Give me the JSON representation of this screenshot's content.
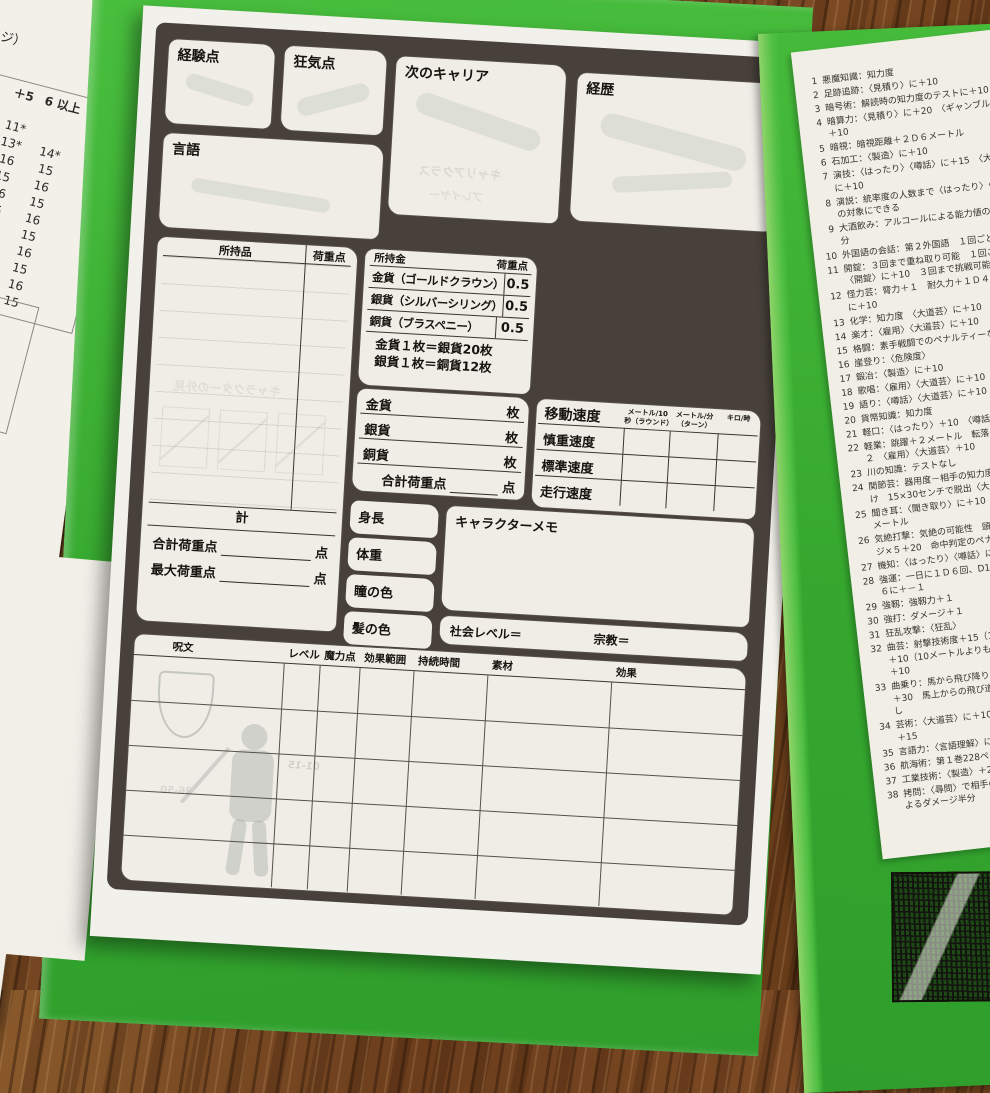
{
  "left_sheets": {
    "sheet1": {
      "top_fragment": "ページ）",
      "corner_label": "値",
      "columns": [
        "＋4",
        "＋5",
        "6 以上"
      ],
      "rows": [
        [
          "7",
          "",
          ""
        ],
        [
          "9*",
          "11*",
          ""
        ],
        [
          "4*",
          "13*",
          "14*"
        ],
        [
          "",
          "16",
          "15"
        ],
        [
          "",
          "15",
          "16"
        ],
        [
          "",
          "16",
          "15"
        ],
        [
          "",
          "15",
          "16"
        ],
        [
          "",
          "16",
          "15"
        ],
        [
          "",
          "15",
          "16"
        ],
        [
          "",
          "16",
          "15"
        ],
        [
          "",
          "15",
          "16"
        ],
        [
          "",
          "",
          "15"
        ]
      ],
      "footer": "せん──戦闘からの"
    },
    "sheet2": {
      "columns": [
        "＋5",
        "＋6"
      ],
      "rows": [
        [
          "し",
          "即死"
        ],
        [
          "死",
          "即死"
        ],
        [
          "死",
          "即死"
        ],
        [
          "死",
          "即死"
        ],
        [
          "死",
          "即死"
        ],
        [
          "死",
          "即死"
        ]
      ]
    }
  },
  "sheet": {
    "boxes": {
      "experience": "経験点",
      "insanity": "狂気点",
      "next_career": "次のキャリア",
      "history": "経歴",
      "language": "言語"
    },
    "possessions": {
      "title": "所持品",
      "weight_col": "荷重点"
    },
    "money": {
      "title": "所持金",
      "weight_col": "荷重点",
      "rows": [
        {
          "label": "金貨（ゴールドクラウン）",
          "weight": "0.5"
        },
        {
          "label": "銀貨（シルバーシリング）",
          "weight": "0.5"
        },
        {
          "label": "銅貨（ブラスペニー）",
          "weight": "0.5"
        }
      ],
      "exchange": [
        "金貨１枚＝銀貨20枚",
        "銀貨１枚＝銅貨12枚"
      ],
      "count_rows": [
        {
          "label": "金貨",
          "unit": "枚"
        },
        {
          "label": "銀貨",
          "unit": "枚"
        },
        {
          "label": "銅貨",
          "unit": "枚"
        }
      ],
      "total_label": "合計荷重点",
      "total_unit": "点"
    },
    "movement": {
      "title": "移動速度",
      "col_headers": [
        "メートル/10秒（ラウンド）",
        "メートル/分（ターン）",
        "キロ/時"
      ],
      "rows": [
        "慎重速度",
        "標準速度",
        "走行速度"
      ]
    },
    "totals": {
      "sum": "計",
      "total_weight": "合計荷重点",
      "max_weight": "最大荷重点",
      "unit": "点"
    },
    "physical": [
      "身長",
      "体重",
      "瞳の色",
      "髪の色"
    ],
    "memo_title": "キャラクターメモ",
    "social_level": "社会レベル＝",
    "religion": "宗教＝",
    "spells": {
      "headers": [
        "呪文",
        "レベル",
        "魔力点",
        "効果範囲",
        "持続時間",
        "素材",
        "効果"
      ]
    },
    "watermarks": {
      "appearance": "キャラクターの外見",
      "career_class": "キャリアクラス",
      "player": "プレイヤー",
      "ranges": [
        "01-15",
        "36-50"
      ]
    }
  },
  "skills_panel": {
    "items": [
      {
        "n": "1",
        "t": "悪魔知識：知力度"
      },
      {
        "n": "2",
        "t": "足跡追跡：〈見積り〉に＋10"
      },
      {
        "n": "3",
        "t": "暗号術：解読時の知力度のテストに＋10"
      },
      {
        "n": "4",
        "t": "暗算力：〈見積り〉に＋20　〈ギャンブル〉に＋10"
      },
      {
        "n": "5",
        "t": "暗視：暗視距離＋２Ｄ６メートル"
      },
      {
        "n": "6",
        "t": "石加工：〈製造〉に＋10"
      },
      {
        "n": "7",
        "t": "演技：〈はったり〉〈噂話〉に＋15　〈大道芸〉に＋10"
      },
      {
        "n": "8",
        "t": "演説：統率度の人数まで〈はったり〉〈噂話〉の対象にできる"
      },
      {
        "n": "9",
        "t": "大酒飲み：アルコールによる能力値の減少半分"
      },
      {
        "n": "10",
        "t": "外国語の会話：第２外国語　１回ごとに分"
      },
      {
        "n": "11",
        "t": "開錠：３回まで重ね取り可能　１回ごとに〈開錠〉に＋10　３回まで挑戦可能"
      },
      {
        "n": "12",
        "t": "怪力芸：膂力＋１　耐久力＋１Ｄ４　〈雇用〉に＋10"
      },
      {
        "n": "13",
        "t": "化学：知力度　〈大道芸〉に＋10"
      },
      {
        "n": "14",
        "t": "楽才：〈雇用〉〈大道芸〉に＋10"
      },
      {
        "n": "15",
        "t": "格闘：素手戦闘でのペナルティーなし"
      },
      {
        "n": "16",
        "t": "崖登り：〈危険度〉"
      },
      {
        "n": "17",
        "t": "鍛冶：〈製造〉に＋10"
      },
      {
        "n": "18",
        "t": "歌唱：〈雇用〉〈大道芸〉に＋10"
      },
      {
        "n": "19",
        "t": "語り：〈噂話〉〈大道芸〉に＋10"
      },
      {
        "n": "20",
        "t": "貨幣知識：知力度"
      },
      {
        "n": "21",
        "t": "軽口：〈はったり〉＋10　〈噂話〉＋15"
      },
      {
        "n": "22",
        "t": "軽業：跳躍＋２メートル　転落のサイコロ＋２　〈雇用〉〈大道芸〉＋10"
      },
      {
        "n": "23",
        "t": "川の知識：テストなし"
      },
      {
        "n": "24",
        "t": "関節芸：器用度－相手の知力度の半分で縄抜け　15×30センチで脱出〈大道芸〉に＋10"
      },
      {
        "n": "25",
        "t": "聞き耳：〈聞き取り〉に＋10　可聴範囲＋２メートル"
      },
      {
        "n": "26",
        "t": "気絶打撃：気絶の可能性　頭に与えたダメージ×５＋20　命中判定のペナルティーなし"
      },
      {
        "n": "27",
        "t": "機知：〈はったり〉〈噂話〉に＋10"
      },
      {
        "n": "28",
        "t": "強運：一日に１Ｄ６回、D100に＋－10、Ｄ６に＋－１"
      },
      {
        "n": "29",
        "t": "強靱：強靱力＋１"
      },
      {
        "n": "30",
        "t": "強打：ダメージ＋１"
      },
      {
        "n": "31",
        "t": "狂乱攻撃：〈狂乱〉"
      },
      {
        "n": "32",
        "t": "曲芸：射撃技術度＋15（10メートル以内）、＋10（10メートルよりも遠い）〈大道芸〉に＋10"
      },
      {
        "n": "33",
        "t": "曲乗り：馬から飛び降りる時の〈危険度〉に＋30　馬上からの飛び道具にペナルティーなし"
      },
      {
        "n": "34",
        "t": "芸術：〈大道芸〉に＋10　鑑定（知力度）に＋15"
      },
      {
        "n": "35",
        "t": "言語力：〈言語理解〉に＋10"
      },
      {
        "n": "36",
        "t": "航海術：第１巻228ページ"
      },
      {
        "n": "37",
        "t": "工業技術：〈製造〉＋20"
      },
      {
        "n": "38",
        "t": "拷問：〈尋問〉で相手の抵抗度－10　拷問によるダメージ半分"
      }
    ]
  }
}
